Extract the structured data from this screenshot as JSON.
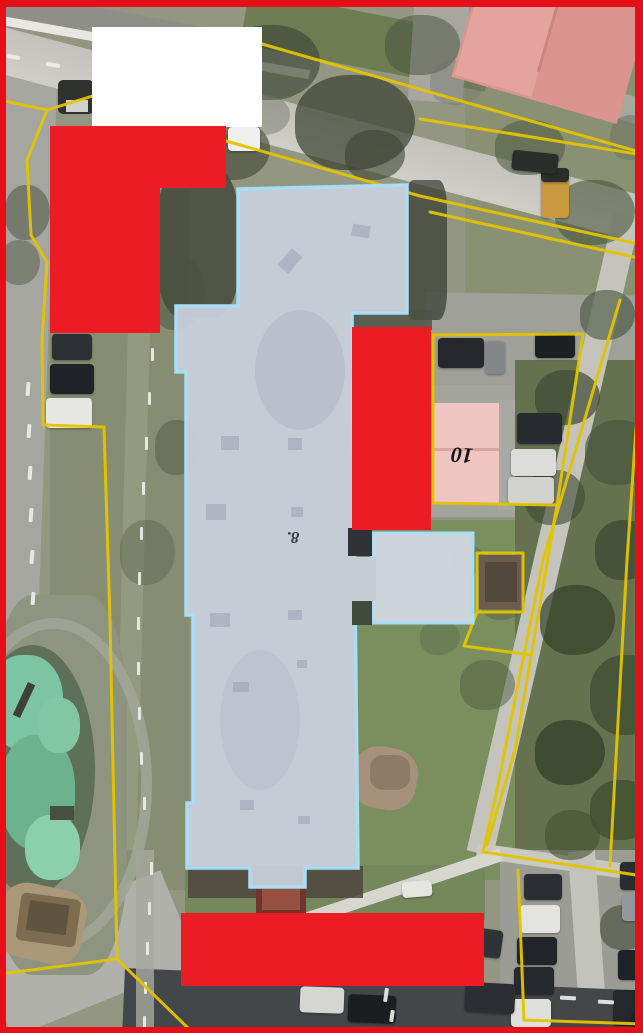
{
  "map": {
    "description": "Aerial cadastral map with highlighted building footprint and redaction boxes",
    "frame": {
      "color": "#e60e17"
    },
    "labels": [
      {
        "name": "building-number-8",
        "text": "8.",
        "x": 293,
        "y": 537,
        "rotation_deg": 180,
        "color": "#373d45",
        "font_size_px": 17
      },
      {
        "name": "building-number-10",
        "text": "10",
        "x": 462,
        "y": 455,
        "rotation_deg": 184,
        "color": "#14141a",
        "font_size_px": 22
      }
    ],
    "legend_colors": {
      "selected_building_fill": "#c8ceda",
      "selected_building_outline": "#a9dcf5",
      "parcel_boundary": "#e3c400",
      "redaction_red": "#ec1c24",
      "redaction_white": "#ffffff"
    },
    "overlays": {
      "selected_building": {
        "name": "building-8-footprint",
        "points": [
          [
            238,
            189
          ],
          [
            407,
            185
          ],
          [
            407,
            313
          ],
          [
            352,
            313
          ],
          [
            358,
            868
          ],
          [
            305,
            868
          ],
          [
            305,
            887
          ],
          [
            250,
            887
          ],
          [
            250,
            868
          ],
          [
            187,
            868
          ],
          [
            187,
            803
          ],
          [
            193,
            803
          ],
          [
            193,
            615
          ],
          [
            186,
            615
          ],
          [
            186,
            372
          ],
          [
            176,
            372
          ],
          [
            176,
            306
          ],
          [
            238,
            306
          ]
        ]
      },
      "annex": {
        "name": "building-8-annex",
        "x": 372,
        "y": 533,
        "w": 101,
        "h": 90
      },
      "parcel_lines": [
        {
          "points": [
            [
              0,
              100
            ],
            [
              47,
              110
            ],
            [
              27,
              160
            ],
            [
              31,
              235
            ],
            [
              47,
              262
            ],
            [
              42,
              340
            ],
            [
              43,
              425
            ],
            [
              104,
              427
            ],
            [
              110,
              620
            ],
            [
              117,
              959
            ],
            [
              188,
              1028
            ]
          ]
        },
        {
          "points": [
            [
              117,
              959
            ],
            [
              0,
              974
            ]
          ]
        },
        {
          "points": [
            [
              47,
              110
            ],
            [
              262,
              44
            ],
            [
              643,
              153
            ]
          ]
        },
        {
          "points": [
            [
              420,
              119
            ],
            [
              643,
              155
            ]
          ]
        },
        {
          "points": [
            [
              226,
              141
            ],
            [
              420,
              196
            ],
            [
              643,
              245
            ]
          ]
        },
        {
          "points": [
            [
              430,
              212
            ],
            [
              643,
              259
            ]
          ]
        },
        {
          "points": [
            [
              620,
              300
            ],
            [
              543,
              560
            ],
            [
              497,
              790
            ],
            [
              483,
              852
            ]
          ]
        },
        {
          "points": [
            [
              641,
              356
            ],
            [
              627,
              560
            ],
            [
              610,
              866
            ]
          ]
        },
        {
          "points": [
            [
              483,
              852
            ],
            [
              643,
              876
            ]
          ]
        },
        {
          "points": [
            [
              518,
              870
            ],
            [
              524,
              1020
            ]
          ]
        },
        {
          "points": [
            [
              524,
              1020
            ],
            [
              643,
              1024
            ]
          ]
        },
        {
          "points": [
            [
              433,
              335
            ],
            [
              583,
              334
            ],
            [
              557,
              505
            ],
            [
              433,
              503
            ],
            [
              433,
              335
            ]
          ]
        },
        {
          "points": [
            [
              557,
              505
            ],
            [
              515,
              750
            ],
            [
              487,
              845
            ]
          ]
        },
        {
          "points": [
            [
              477,
              553
            ],
            [
              523,
              553
            ],
            [
              523,
              612
            ],
            [
              477,
              612
            ],
            [
              477,
              553
            ]
          ]
        },
        {
          "points": [
            [
              477,
              612
            ],
            [
              464,
              646
            ],
            [
              531,
              655
            ]
          ]
        }
      ],
      "redactions": [
        {
          "name": "redaction-white-top",
          "color": "#ffffff",
          "x": 92,
          "y": 27,
          "w": 170,
          "h": 100
        },
        {
          "name": "redaction-red-top-wide",
          "color": "#ec1c24",
          "x": 50,
          "y": 126,
          "w": 176,
          "h": 62
        },
        {
          "name": "redaction-red-left",
          "color": "#ec1c24",
          "x": 50,
          "y": 126,
          "w": 110,
          "h": 207
        },
        {
          "name": "redaction-red-middle",
          "color": "#ec1c24",
          "x": 352,
          "y": 327,
          "w": 79,
          "h": 203
        },
        {
          "name": "redaction-red-bottom",
          "color": "#ec1c24",
          "x": 181,
          "y": 913,
          "w": 303,
          "h": 73
        }
      ]
    }
  }
}
